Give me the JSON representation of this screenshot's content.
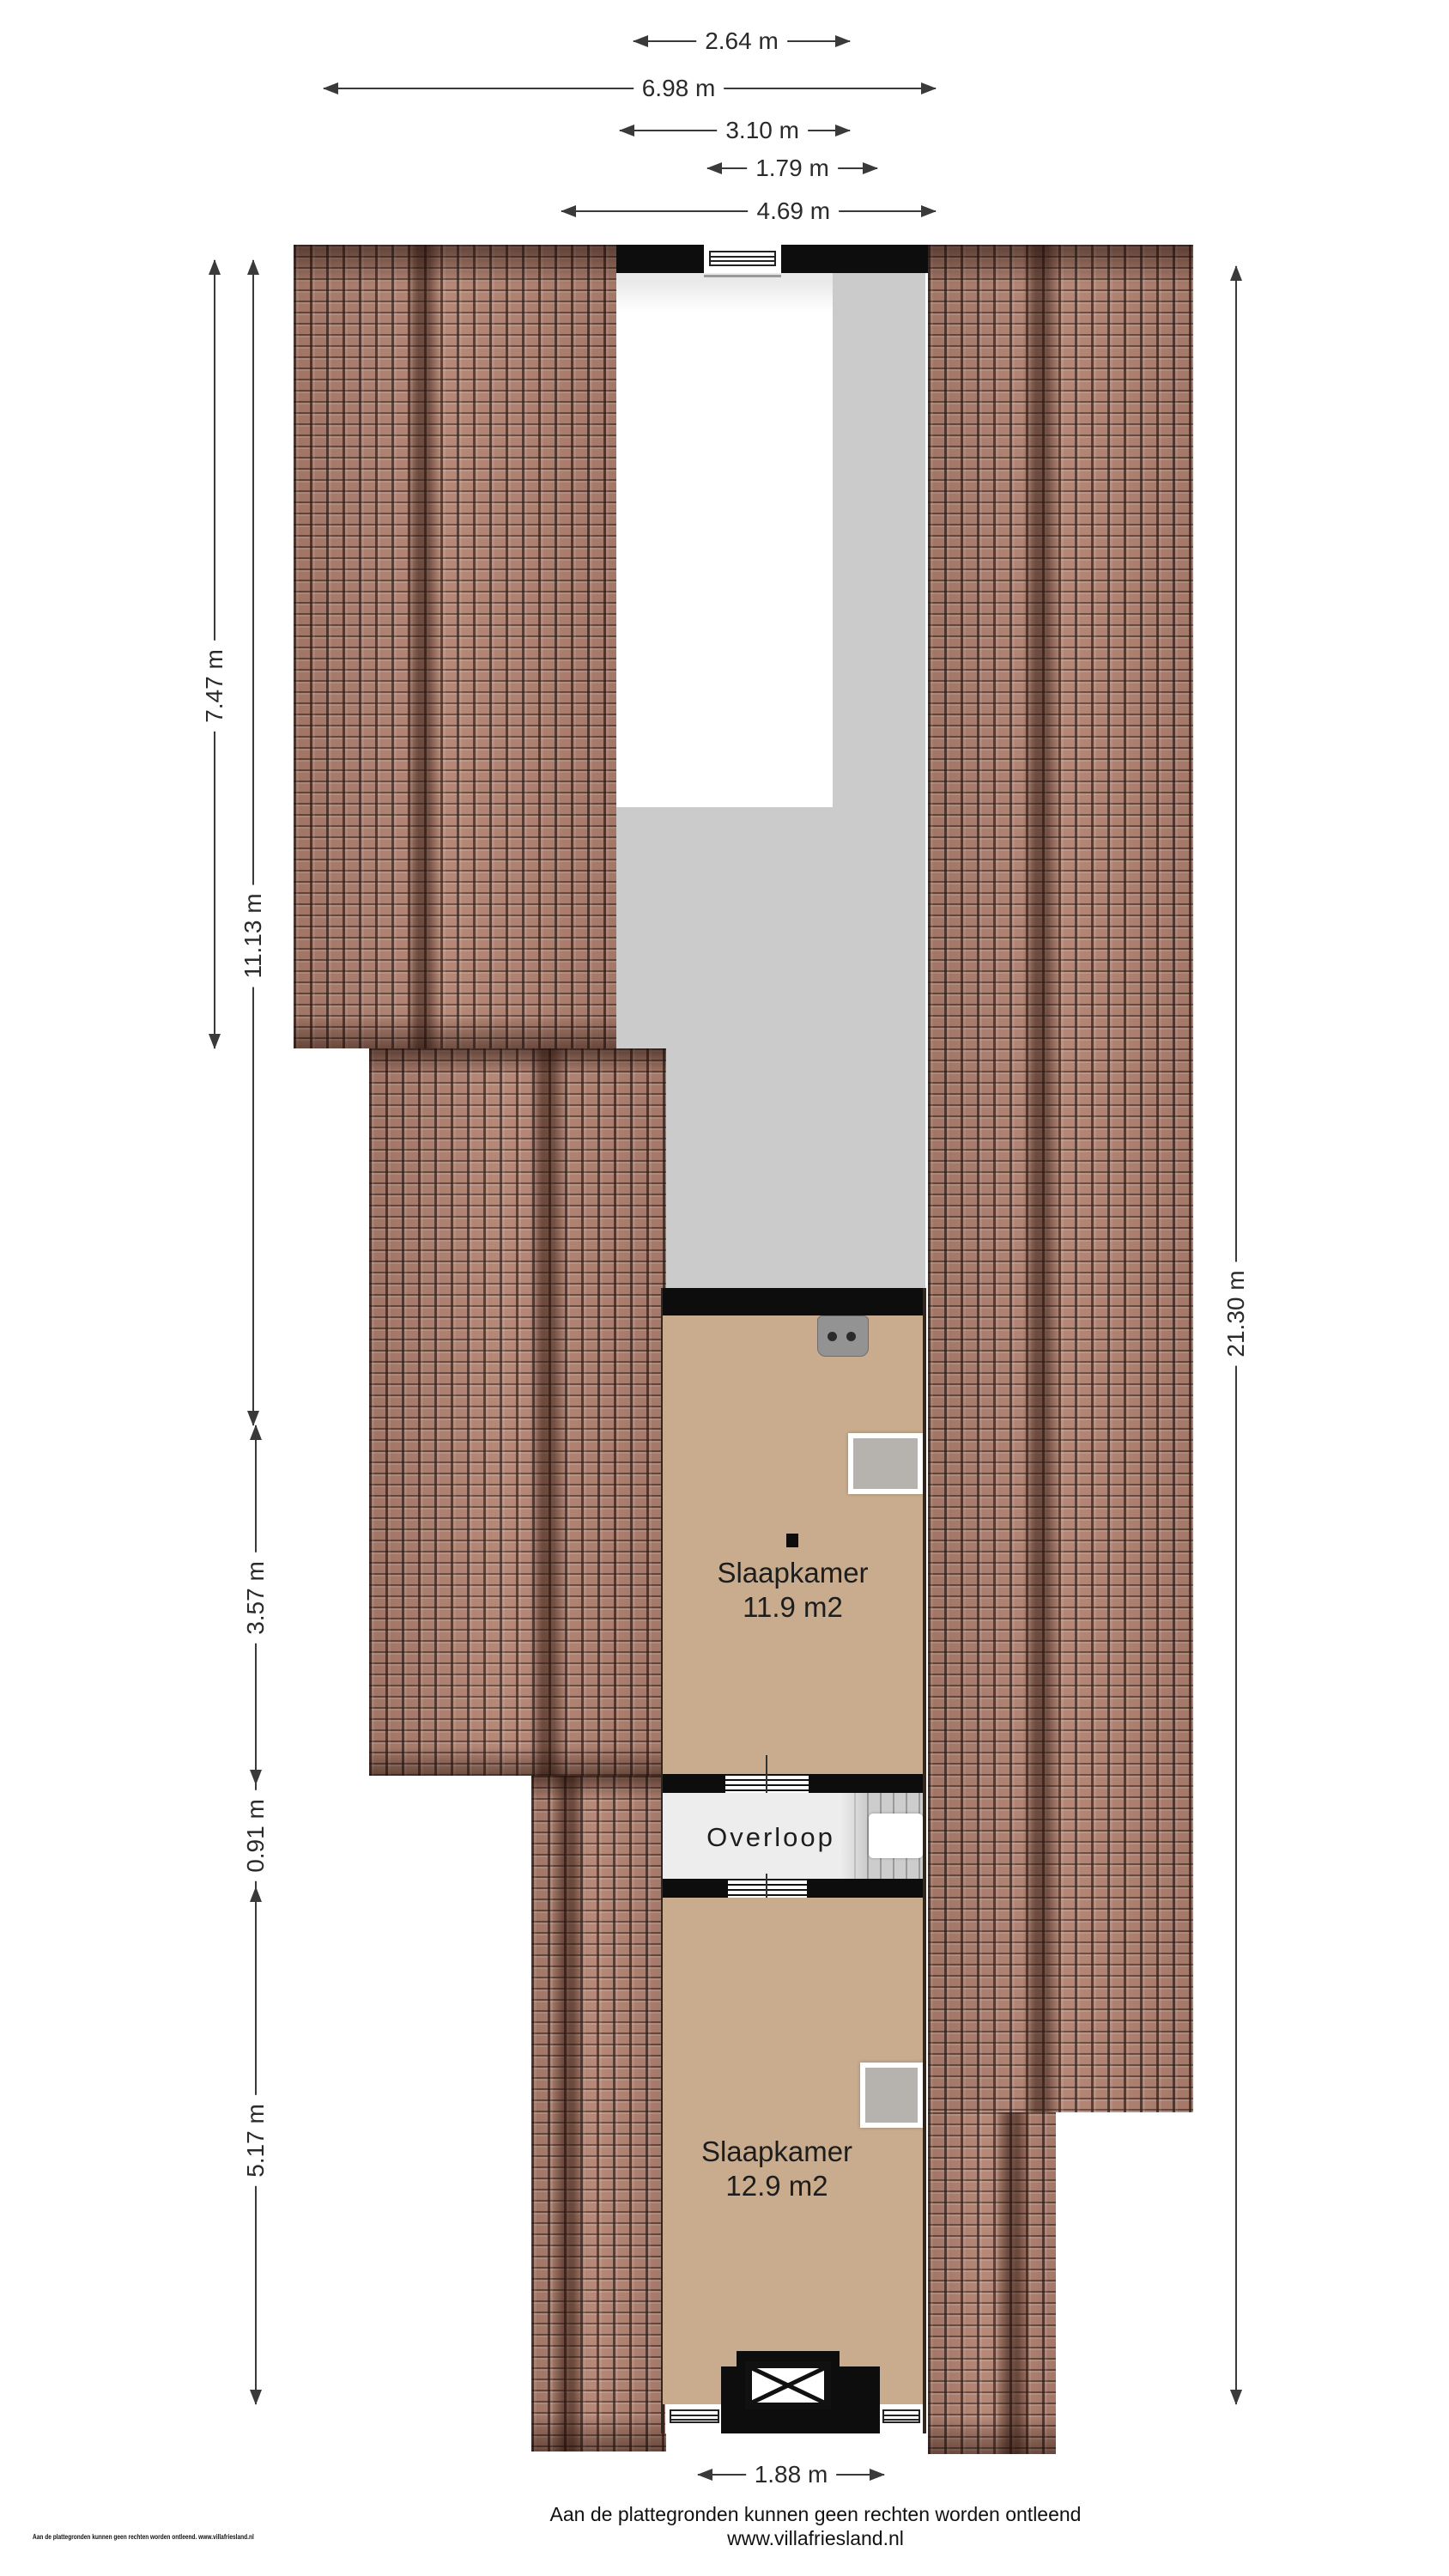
{
  "plan_title": "Floor plan attic storey",
  "dims": {
    "top": [
      {
        "label": "2.64 m"
      },
      {
        "label": "6.98 m"
      },
      {
        "label": "3.10 m"
      },
      {
        "label": "1.79 m"
      },
      {
        "label": "4.69 m"
      }
    ],
    "left": [
      {
        "label": "7.47 m"
      },
      {
        "label": "11.13 m"
      },
      {
        "label": "3.57 m"
      },
      {
        "label": "0.91 m"
      },
      {
        "label": "5.17 m"
      }
    ],
    "right": [
      {
        "label": "21.30 m"
      }
    ],
    "bottom": [
      {
        "label": "1.88 m"
      }
    ]
  },
  "rooms": {
    "bedroom1": {
      "name": "Slaapkamer",
      "area": "11.9 m2"
    },
    "landing": {
      "name": "Overloop"
    },
    "bedroom2": {
      "name": "Slaapkamer",
      "area": "12.9 m2"
    }
  },
  "footer": {
    "disclaimer": "Aan de plattegronden kunnen geen rechten worden ontleend",
    "website": "www.villafriesland.nl",
    "small_print": "Aan de plattegronden kunnen geen rechten worden ontleend. www.villafriesland.nl"
  },
  "colors": {
    "roof_tile": "#b28271",
    "roof_fold_dark": "#5f4335",
    "wall_black": "#0d0d0d",
    "floor_tan": "#c9ac8d",
    "void_gray": "#cbcbcb",
    "landing_floor": "#ededed",
    "stairs_gray": "#cdcdcd",
    "furniture_gray": "#b6b2ae",
    "dimension_text": "#2a2a2a"
  }
}
